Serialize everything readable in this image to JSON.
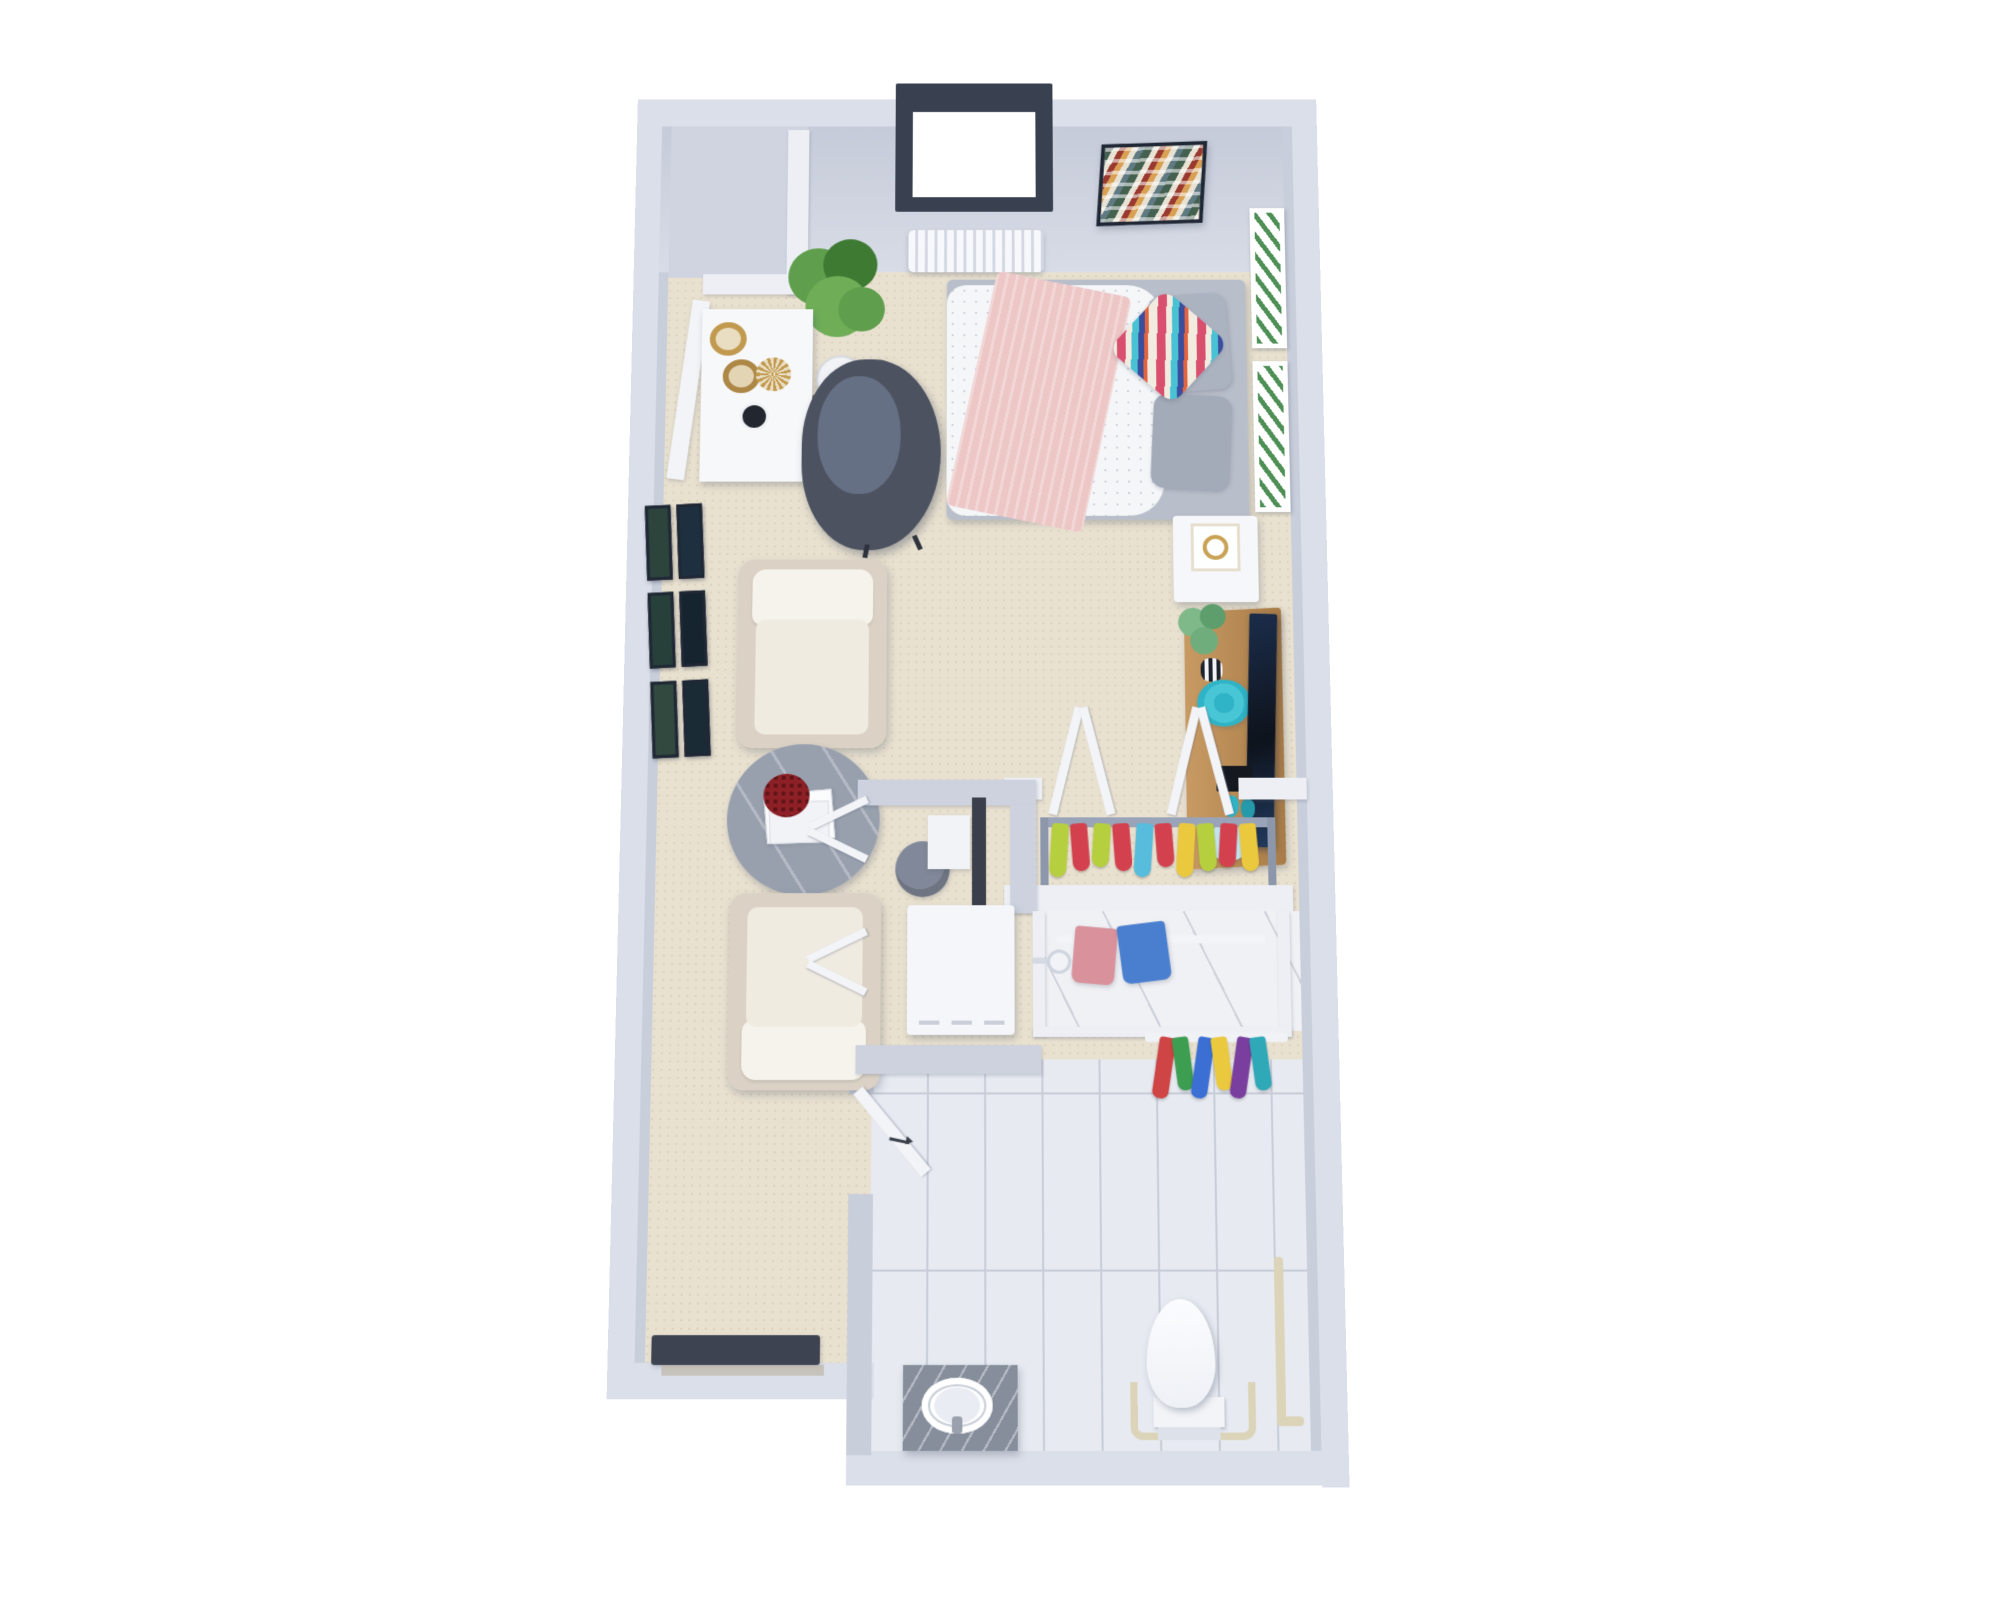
{
  "image": {
    "type": "3d-floor-plan-render",
    "description": "Top-down 3D rendering of a furnished studio apartment with open living/sleeping area, wardrobe closet, utility closet and accessible bathroom with walk-in shower",
    "background": "#ffffff"
  },
  "palette": {
    "wall_outer": "#dbdfe9",
    "wall_face_dark": "#c6cbd9",
    "wall_face_light": "#d8dce6",
    "wall_inner": "#c9cedb",
    "void_gray": "#cfd4e0",
    "partition_white": "#edeff5",
    "carpet": "#e9e1d0",
    "carpet_dot": "#dcd2bd",
    "tile": "#e7eaf1",
    "tile_grout": "#c8cdd8",
    "marble": "#f0f1f5",
    "window_frame": "#394050",
    "glass_white": "#ffffff",
    "radiator_fin": "#f7f8fb",
    "radiator_fin_shadow": "#d3d8e2",
    "plant_green": "#5f9e4c",
    "plant_green_dark": "#3f7a33",
    "monstera_green": "#7fb98a",
    "desk_white": "#f7f8fa",
    "brass_gold": "#c19a4f",
    "chair_dark": "#4c5260",
    "chair_dark_seat": "#667085",
    "cream_chair": "#f0ebe1",
    "cream_chair_base": "#dbd2c5",
    "cushion_white": "#f6f3ec",
    "table_marble": "#98a0ae",
    "book_white": "#fbfcfd",
    "flower_red": "#7e1d22",
    "bed_base": "#b9bfca",
    "duvet_white": "#f4f6f8",
    "duvet_dot": "#cdd3db",
    "throw_pink": "#edc6c6",
    "pillow_gray": "#acb3c0",
    "pillow_cream": "#f1ebe0",
    "accent_red_pink": "#d94f6e",
    "accent_teal": "#49c2d4",
    "accent_blue": "#3b4e9e",
    "accent_orange": "#e2633f",
    "frame_dark": "#202735",
    "print_green": "#4e8f56",
    "nightstand_white": "#f6f7fa",
    "lamp_gold": "#c9a254",
    "wood": "#c89a63",
    "wood_dark": "#a87c48",
    "tv_black": "#0e131c",
    "teal_decor": "#2fb3c6",
    "blue_box": "#c2e2ec",
    "closet_rail": "#9aa4b8",
    "towel_pink": "#d9919b",
    "towel_blue": "#4a7fd0",
    "grab_bar": "#dcd4b8",
    "toilet_white": "#fbfcfe",
    "vanity_marble": "#868e9b",
    "mat_dark": "#3d4350",
    "door_white": "#f3f4f8",
    "art_green": "#44604f",
    "art_cream": "#e8e2d4",
    "art_maroon": "#99392f",
    "art_mustard": "#d9a054",
    "art_steel": "#5f7a83",
    "washer_white": "#f4f6f9",
    "heater_gray": "#6e7481",
    "panel_dark": "#3a3f4b"
  },
  "rooms": [
    {
      "id": "studio",
      "name": "open living and sleeping area",
      "floor": "beige carpet"
    },
    {
      "id": "wardrobe",
      "name": "open wardrobe closet",
      "floor": "beige carpet"
    },
    {
      "id": "utility",
      "name": "utility closet with washer and water heater",
      "floor": "beige carpet"
    },
    {
      "id": "bathroom",
      "name": "accessible bathroom",
      "floor": "white tile"
    },
    {
      "id": "shower",
      "name": "walk-in shower",
      "floor": "white marble"
    }
  ],
  "furniture": [
    {
      "id": "window",
      "label": "window in top wall"
    },
    {
      "id": "chevron-wall-art",
      "label": "framed chevron weave artwork"
    },
    {
      "id": "radiator",
      "label": "white wall radiator"
    },
    {
      "id": "fiddle-plant",
      "label": "potted fiddle leaf plant"
    },
    {
      "id": "desk",
      "label": "white desk with brass baskets and decor"
    },
    {
      "id": "dark-armchair",
      "label": "dark gray tub chair"
    },
    {
      "id": "gallery-wall",
      "label": "six framed prints on left wall"
    },
    {
      "id": "cream-armchairs",
      "label": "two cream lounge chairs"
    },
    {
      "id": "coffee-table",
      "label": "round marble side table with books and red flowers"
    },
    {
      "id": "bed",
      "label": "bed with dotted duvet, pink knit throw, gray and chevron pillows"
    },
    {
      "id": "leaning-prints",
      "label": "two botanical prints above headboard"
    },
    {
      "id": "nightstand",
      "label": "white nightstand with gold lamp"
    },
    {
      "id": "media-console",
      "label": "wood media console with TV, monstera and teal decor"
    },
    {
      "id": "wardrobe-doors",
      "label": "two bifold closet doors, open"
    },
    {
      "id": "hanging-clothes",
      "label": "colorful clothes on closet rod"
    },
    {
      "id": "washer",
      "label": "washer unit"
    },
    {
      "id": "water-heater",
      "label": "cylindrical water heater"
    },
    {
      "id": "entry-mat",
      "label": "dark entry mat"
    }
  ],
  "fixtures": [
    {
      "id": "bath-door",
      "label": "bathroom door with swing arrow"
    },
    {
      "id": "vanity",
      "label": "marble vanity with round sink"
    },
    {
      "id": "toilet",
      "label": "toilet with surrounding grab rail"
    },
    {
      "id": "grab-bars",
      "label": "wall grab bars"
    },
    {
      "id": "shower-head",
      "label": "shower head"
    },
    {
      "id": "shower-towels",
      "label": "pink and blue towels on shower rod"
    },
    {
      "id": "bath-towels",
      "label": "striped towels on right wall"
    }
  ],
  "decor_colors": {
    "gallery_frames": [
      "#2c443c",
      "#1e303f",
      "#27403a",
      "#15242e",
      "#31493f",
      "#1a2b36"
    ],
    "closet_clothes": [
      "#b6cf3f",
      "#d4414e",
      "#b6cf3f",
      "#d4414e",
      "#58bcdc",
      "#d4414e",
      "#eac93e",
      "#b6cf3f",
      "#d4414e",
      "#eac93e"
    ],
    "bath_towels": [
      "#cf4444",
      "#3d9e52",
      "#3b6fd4",
      "#eac93e",
      "#7a3f9e",
      "#2fa8b8"
    ]
  }
}
